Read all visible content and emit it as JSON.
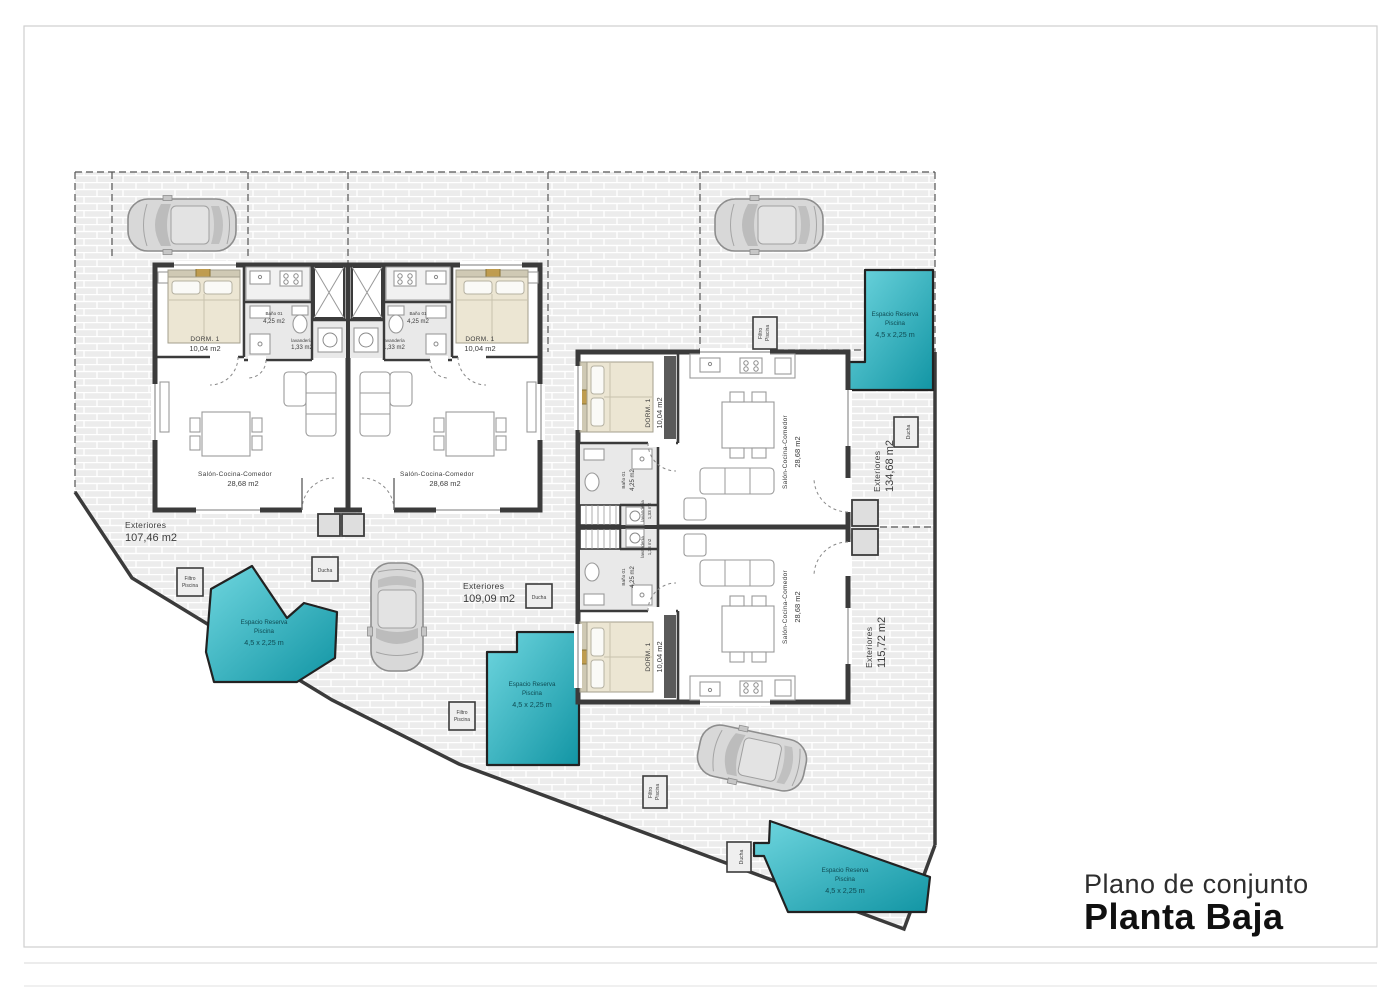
{
  "title": {
    "subtitle": "Plano de conjunto",
    "heading": "Planta Baja"
  },
  "rooms": {
    "bedroom": "DORM. 1",
    "bedroom_area": "10,04 m2",
    "bath": "Baño 01",
    "bath_area": "4,25 m2",
    "laundry": "lavandería",
    "laundry_area": "1,33 m2",
    "living": "Salón-Cocina-Comedor",
    "living_area": "28,68 m2"
  },
  "exteriors": {
    "label": "Exteriores",
    "areas": [
      "107,46 m2",
      "109,09 m2",
      "134,68 m2",
      "115,72 m2"
    ]
  },
  "pool": {
    "line1": "Espacio Reserva",
    "line2": "Piscina",
    "line3": "4,5 x 2,25 m"
  },
  "equipment": {
    "shower": "Ducha",
    "filter_line1": "Filtro",
    "filter_line2": "Piscina"
  },
  "colors": {
    "pool_gradient_start": "#6fd6df",
    "pool_gradient_end": "#1295a4",
    "wall": "#3b3b3b",
    "paving": "#ececec",
    "bed_blanket": "#ece6d3",
    "accent_wood": "#bf9c4f"
  }
}
